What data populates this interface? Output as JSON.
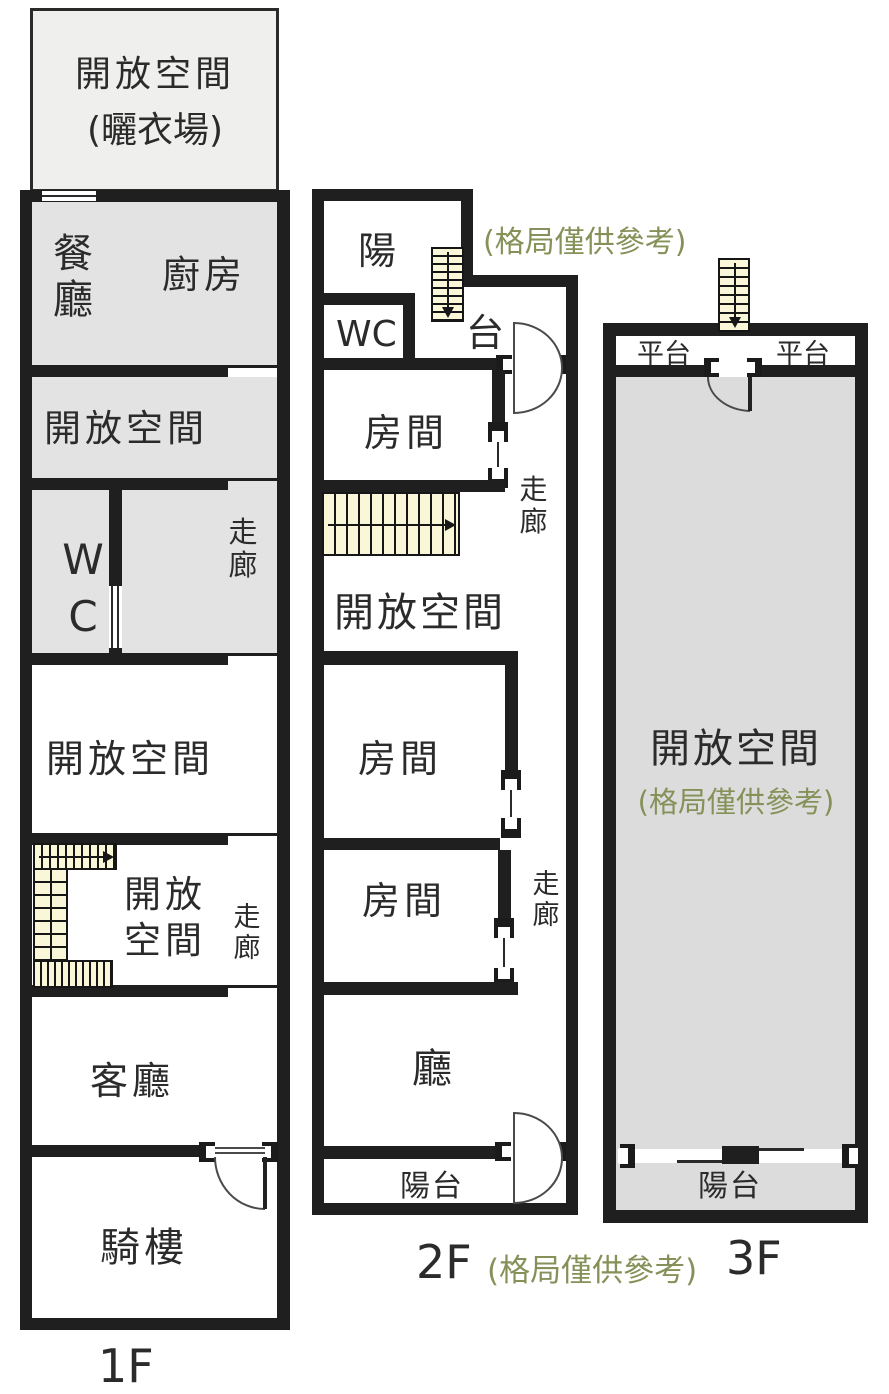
{
  "colors": {
    "wall": "#1f1f1f",
    "room_gray": "#e3e3e3",
    "room_gray_dark": "#dcdcdc",
    "rooftop": "#efefee",
    "stair": "#faf6d8",
    "note_green": "#859158",
    "text": "#2b2b2b"
  },
  "f1": {
    "floor_label": "1F",
    "rooftop_line1": "開放空間",
    "rooftop_line2": "(曬衣場)",
    "dining": "餐廳",
    "kitchen": "廚房",
    "open_a": "開放空間",
    "wc": "WC",
    "corridor_a": "走廊",
    "open_b": "開放空間",
    "open_c": "開放空間",
    "corridor_b": "走廊",
    "living": "客廳",
    "arcade": "騎樓"
  },
  "f2": {
    "floor_label": "2F",
    "note_top": "(格局僅供參考)",
    "note_bottom": "(格局僅供參考)",
    "balcony_char_a": "陽",
    "balcony_char_b": "台",
    "wc": "WC",
    "room_1": "房間",
    "open": "開放空間",
    "room_2": "房間",
    "room_3": "房間",
    "corridor_a": "走廊",
    "corridor_b": "走廊",
    "hall": "廳",
    "balcony_bottom": "陽台"
  },
  "f3": {
    "floor_label": "3F",
    "platform_left": "平台",
    "platform_right": "平台",
    "open": "開放空間",
    "note": "(格局僅供參考)",
    "balcony": "陽台"
  }
}
